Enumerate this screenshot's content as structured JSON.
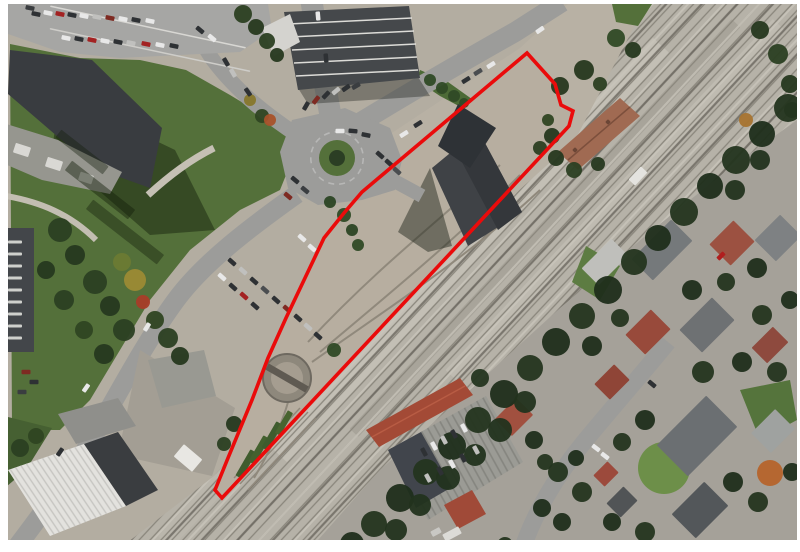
{
  "canvas": {
    "width": 800,
    "height": 552,
    "page_background": "#ffffff",
    "photo": {
      "x": 8,
      "y": 4,
      "width": 789,
      "height": 536
    }
  },
  "palette": {
    "page": "#ffffff",
    "base": "#b3ada1",
    "corridor": "#b6b2a8",
    "track_line": "#8a867c",
    "track_dark": "#6f6b63",
    "ballast_light": "#c6c2b8",
    "dirt": "#b8b1a4",
    "interior_dirt": "#b7aea0",
    "road": "#9c9c9a",
    "se_base": "#a5a199",
    "grass": "#54703a",
    "grass_dark": "#31451f",
    "grass_bright": "#6d8f49",
    "tree_dark": "#24351f",
    "roof_dark": "#3f4246",
    "roof_gray": "#85888a",
    "roof_red": "#9c5141",
    "roof_brick": "#a34a36",
    "white_roof": "#e3e2de",
    "boundary_red": "#ea0b0b"
  },
  "boundary": {
    "label": "site-boundary-annotation",
    "color": "#ea0b0b",
    "stroke_width": 3.6,
    "points": [
      [
        527,
        53
      ],
      [
        555,
        84
      ],
      [
        561,
        105
      ],
      [
        573,
        111
      ],
      [
        569,
        126
      ],
      [
        222,
        498
      ],
      [
        215,
        490
      ],
      [
        228,
        458
      ],
      [
        252,
        400
      ],
      [
        268,
        358
      ],
      [
        286,
        318
      ],
      [
        305,
        278
      ],
      [
        324,
        238
      ],
      [
        344,
        213
      ],
      [
        362,
        192
      ]
    ]
  },
  "scene": {
    "turntable": {
      "cx": 287,
      "cy": 378,
      "r_outer": 24,
      "r_inner": 16,
      "bridge_rot": 30
    },
    "roundabout": {
      "cx": 337,
      "cy": 158,
      "r_ring": 41,
      "r_green": 18,
      "r_bush": 8
    },
    "ballast_bands": [
      [
        470,
        250,
        560,
        22,
        -47,
        "#c3bfb5"
      ],
      [
        545,
        228,
        560,
        12,
        -47,
        "#a8a49a"
      ],
      [
        615,
        200,
        480,
        16,
        -47,
        "#bfbbb1"
      ],
      [
        350,
        340,
        380,
        14,
        -47,
        "#a29e94"
      ],
      [
        260,
        440,
        280,
        18,
        -47,
        "#bab6ac"
      ]
    ],
    "deco_rects": [
      [
        246,
        464,
        30,
        7,
        -60,
        "#3f5c2e"
      ],
      [
        259,
        450,
        30,
        7,
        -60,
        "#44612f"
      ],
      [
        272,
        436,
        30,
        7,
        -60,
        "#3f5c2e"
      ],
      [
        284,
        423,
        26,
        6,
        -60,
        "#486430"
      ],
      [
        15,
        242,
        14,
        3,
        0,
        "#cfd0cc"
      ],
      [
        15,
        254,
        14,
        3,
        0,
        "#cfd0cc"
      ],
      [
        15,
        266,
        14,
        3,
        0,
        "#cfd0cc"
      ],
      [
        15,
        278,
        14,
        3,
        0,
        "#cfd0cc"
      ],
      [
        15,
        290,
        14,
        3,
        0,
        "#cfd0cc"
      ],
      [
        15,
        302,
        14,
        3,
        0,
        "#cfd0cc"
      ],
      [
        15,
        314,
        14,
        3,
        0,
        "#cfd0cc"
      ],
      [
        15,
        326,
        14,
        3,
        0,
        "#cfd0cc"
      ],
      [
        15,
        338,
        14,
        3,
        0,
        "#cfd0cc"
      ],
      [
        22,
        150,
        16,
        10,
        18,
        "#d9d8d4"
      ],
      [
        54,
        164,
        16,
        10,
        18,
        "#d9d8d4"
      ],
      [
        86,
        178,
        14,
        9,
        18,
        "#cfceca"
      ],
      [
        188,
        458,
        24,
        16,
        40,
        "#e8e7e3"
      ],
      [
        638,
        176,
        18,
        9,
        -47,
        "#e4e3df"
      ],
      [
        575,
        150,
        4,
        4,
        -45,
        "#6b4636"
      ],
      [
        608,
        122,
        4,
        4,
        -45,
        "#6b4636"
      ],
      [
        452,
        534,
        18,
        8,
        -28,
        "#dcdbd7"
      ],
      [
        436,
        532,
        10,
        6,
        -28,
        "#c9c8c4"
      ],
      [
        148,
        27,
        200,
        1.5,
        12,
        "#d8d7d3"
      ],
      [
        150,
        50,
        205,
        1.5,
        12,
        "#cecdc9"
      ],
      [
        100,
        190,
        80,
        12,
        38,
        "rgba(20,30,12,0.45)"
      ],
      [
        125,
        232,
        90,
        12,
        38,
        "rgba(20,30,12,0.40)"
      ],
      [
        82,
        152,
        60,
        10,
        38,
        "rgba(20,30,12,0.40)"
      ]
    ],
    "houses": [
      [
        605,
        262,
        42,
        24,
        -45,
        "#bfbfbb"
      ],
      [
        662,
        250,
        56,
        30,
        -45,
        "#75797b"
      ],
      [
        732,
        243,
        34,
        30,
        -45,
        "#9c5141"
      ],
      [
        778,
        238,
        36,
        30,
        -45,
        "#7e8183"
      ],
      [
        648,
        332,
        36,
        28,
        -45,
        "#984a3b"
      ],
      [
        707,
        325,
        46,
        32,
        -45,
        "#6e7173"
      ],
      [
        770,
        345,
        30,
        22,
        -45,
        "#8e4a3e"
      ],
      [
        612,
        382,
        28,
        22,
        -45,
        "#8f4537"
      ],
      [
        697,
        436,
        70,
        44,
        -45,
        "#6b6f72"
      ],
      [
        773,
        431,
        34,
        28,
        -45,
        "#9fa2a0"
      ],
      [
        700,
        510,
        46,
        34,
        -45,
        "#53575a"
      ],
      [
        622,
        502,
        24,
        20,
        -45,
        "#515456"
      ],
      [
        606,
        474,
        20,
        16,
        -45,
        "#9c4a3c"
      ],
      [
        514,
        417,
        30,
        24,
        -45,
        "#a1503f"
      ]
    ],
    "trees": [
      [
        243,
        14,
        9,
        "#2b3f22"
      ],
      [
        256,
        27,
        8,
        "#26381f"
      ],
      [
        267,
        41,
        8,
        "#2b3f22"
      ],
      [
        277,
        55,
        7,
        "#26381f"
      ],
      [
        60,
        230,
        12,
        "#2b3f22"
      ],
      [
        75,
        255,
        10,
        "#26381f"
      ],
      [
        95,
        282,
        12,
        "#2b3f22"
      ],
      [
        110,
        306,
        10,
        "#26381f"
      ],
      [
        124,
        330,
        11,
        "#2b3f22"
      ],
      [
        104,
        354,
        10,
        "#26381f"
      ],
      [
        84,
        330,
        9,
        "#2f4522"
      ],
      [
        64,
        300,
        10,
        "#2b3f22"
      ],
      [
        46,
        270,
        9,
        "#26381f"
      ],
      [
        135,
        280,
        11,
        "#9c8a34"
      ],
      [
        143,
        302,
        7,
        "#a83c28"
      ],
      [
        122,
        262,
        9,
        "#6b7a33"
      ],
      [
        155,
        320,
        9,
        "#2f4522"
      ],
      [
        168,
        338,
        10,
        "#2b3f22"
      ],
      [
        180,
        356,
        9,
        "#26381f"
      ],
      [
        20,
        448,
        9,
        "#2b3f22"
      ],
      [
        36,
        436,
        8,
        "#2f4522"
      ],
      [
        430,
        80,
        6,
        "#2f4a26"
      ],
      [
        442,
        88,
        6,
        "#2f4a26"
      ],
      [
        454,
        96,
        6,
        "#2f4a26"
      ],
      [
        464,
        103,
        5,
        "#2f4a26"
      ],
      [
        262,
        116,
        7,
        "#2f4522"
      ],
      [
        250,
        100,
        6,
        "#87772c"
      ],
      [
        270,
        120,
        6,
        "#a8522a"
      ],
      [
        560,
        86,
        9,
        "#26381f"
      ],
      [
        584,
        70,
        10,
        "#26381f"
      ],
      [
        600,
        84,
        7,
        "#2b3f22"
      ],
      [
        548,
        120,
        6,
        "#2f4522"
      ],
      [
        556,
        158,
        8,
        "#26381f"
      ],
      [
        574,
        170,
        8,
        "#2b3f22"
      ],
      [
        598,
        164,
        7,
        "#26381f"
      ],
      [
        552,
        136,
        8,
        "#26381f"
      ],
      [
        540,
        148,
        7,
        "#2b3f22"
      ],
      [
        616,
        38,
        9,
        "#2f4a26"
      ],
      [
        633,
        50,
        8,
        "#26381f"
      ],
      [
        760,
        30,
        9,
        "#26381f"
      ],
      [
        778,
        54,
        10,
        "#2b3f22"
      ],
      [
        790,
        84,
        9,
        "#26381f"
      ],
      [
        792,
        110,
        8,
        "#2b3f22"
      ],
      [
        788,
        108,
        14,
        "#24351f"
      ],
      [
        762,
        134,
        13,
        "#1f2e1b"
      ],
      [
        736,
        160,
        14,
        "#24351f"
      ],
      [
        710,
        186,
        13,
        "#1f2e1b"
      ],
      [
        684,
        212,
        14,
        "#24351f"
      ],
      [
        658,
        238,
        13,
        "#1f2e1b"
      ],
      [
        634,
        262,
        13,
        "#24351f"
      ],
      [
        608,
        290,
        14,
        "#1f2e1b"
      ],
      [
        582,
        316,
        13,
        "#24351f"
      ],
      [
        556,
        342,
        14,
        "#1f2e1b"
      ],
      [
        530,
        368,
        13,
        "#24351f"
      ],
      [
        504,
        394,
        14,
        "#1f2e1b"
      ],
      [
        478,
        420,
        13,
        "#24351f"
      ],
      [
        452,
        446,
        14,
        "#1f2e1b"
      ],
      [
        426,
        472,
        13,
        "#24351f"
      ],
      [
        400,
        498,
        14,
        "#1f2e1b"
      ],
      [
        374,
        524,
        13,
        "#24351f"
      ],
      [
        352,
        544,
        12,
        "#1f2e1b"
      ],
      [
        500,
        430,
        12,
        "#22331d"
      ],
      [
        525,
        402,
        11,
        "#22331d"
      ],
      [
        475,
        455,
        11,
        "#22331d"
      ],
      [
        448,
        478,
        12,
        "#22331d"
      ],
      [
        420,
        505,
        11,
        "#22331d"
      ],
      [
        396,
        530,
        11,
        "#22331d"
      ],
      [
        760,
        160,
        10,
        "#22331d"
      ],
      [
        735,
        190,
        10,
        "#22331d"
      ],
      [
        746,
        120,
        7,
        "#a87430"
      ],
      [
        692,
        290,
        10,
        "#1f2e1b"
      ],
      [
        726,
        282,
        9,
        "#24351f"
      ],
      [
        757,
        268,
        10,
        "#1f2e1b"
      ],
      [
        620,
        318,
        9,
        "#24351f"
      ],
      [
        592,
        346,
        10,
        "#1f2e1b"
      ],
      [
        762,
        315,
        10,
        "#24351f"
      ],
      [
        790,
        300,
        9,
        "#1f2e1b"
      ],
      [
        703,
        372,
        11,
        "#24351f"
      ],
      [
        742,
        362,
        10,
        "#1f2e1b"
      ],
      [
        777,
        372,
        10,
        "#24351f"
      ],
      [
        645,
        420,
        10,
        "#1f2e1b"
      ],
      [
        622,
        442,
        9,
        "#24351f"
      ],
      [
        733,
        482,
        10,
        "#1f2e1b"
      ],
      [
        758,
        502,
        10,
        "#24351f"
      ],
      [
        792,
        472,
        9,
        "#1f2e1b"
      ],
      [
        645,
        532,
        10,
        "#24351f"
      ],
      [
        612,
        522,
        9,
        "#1f2e1b"
      ],
      [
        582,
        492,
        10,
        "#24351f"
      ],
      [
        562,
        522,
        9,
        "#1f2e1b"
      ],
      [
        545,
        462,
        8,
        "#24351f"
      ],
      [
        576,
        458,
        8,
        "#1f2e1b"
      ],
      [
        770,
        473,
        13,
        "#b5642b"
      ],
      [
        480,
        378,
        9,
        "#24351f"
      ],
      [
        534,
        440,
        9,
        "#1f2e1b"
      ],
      [
        558,
        472,
        10,
        "#24351f"
      ],
      [
        542,
        508,
        9,
        "#1f2e1b"
      ],
      [
        505,
        545,
        8,
        "#24351f"
      ],
      [
        334,
        350,
        7,
        "#2f4a26"
      ],
      [
        344,
        215,
        7,
        "#2f4a26"
      ],
      [
        352,
        230,
        6,
        "#2b4424"
      ],
      [
        358,
        245,
        6,
        "#2f4a26"
      ],
      [
        330,
        202,
        6,
        "#2b4424"
      ],
      [
        234,
        424,
        8,
        "#26381f"
      ],
      [
        224,
        444,
        7,
        "#2b3f22"
      ]
    ],
    "cars": [
      [
        36,
        14,
        12,
        "#2e3134"
      ],
      [
        48,
        13,
        12,
        "#e8e8e8"
      ],
      [
        60,
        14,
        12,
        "#a32222"
      ],
      [
        72,
        15,
        12,
        "#2e3134"
      ],
      [
        84,
        16,
        12,
        "#e8e8e8"
      ],
      [
        97,
        17,
        12,
        "#c0c0be"
      ],
      [
        110,
        18,
        12,
        "#7e2a22"
      ],
      [
        123,
        19,
        12,
        "#e8e8e8"
      ],
      [
        136,
        20,
        12,
        "#2e3134"
      ],
      [
        150,
        21,
        12,
        "#e8e8e8"
      ],
      [
        66,
        38,
        12,
        "#e8e8e8"
      ],
      [
        79,
        39,
        12,
        "#2e3134"
      ],
      [
        92,
        40,
        12,
        "#a32222"
      ],
      [
        105,
        41,
        12,
        "#e8e8e8"
      ],
      [
        118,
        42,
        12,
        "#2e3134"
      ],
      [
        131,
        43,
        12,
        "#c0c0be"
      ],
      [
        146,
        44,
        12,
        "#a32222"
      ],
      [
        160,
        45,
        12,
        "#e8e8e8"
      ],
      [
        174,
        46,
        12,
        "#2e3134"
      ],
      [
        30,
        8,
        12,
        "#3a3d40"
      ],
      [
        200,
        30,
        40,
        "#2e3134"
      ],
      [
        212,
        38,
        40,
        "#e8e8e8"
      ],
      [
        306,
        106,
        -60,
        "#2e3134"
      ],
      [
        316,
        100,
        -52,
        "#7e2a22"
      ],
      [
        326,
        95,
        -46,
        "#2e3134"
      ],
      [
        336,
        91,
        -40,
        "#c0c0be"
      ],
      [
        346,
        88,
        -35,
        "#2e3134"
      ],
      [
        356,
        86,
        -30,
        "#3a3d40"
      ],
      [
        318,
        16,
        85,
        "#e8e8e8"
      ],
      [
        326,
        58,
        85,
        "#2e3134"
      ],
      [
        404,
        134,
        -32,
        "#e8e8e8"
      ],
      [
        418,
        124,
        -32,
        "#2e3134"
      ],
      [
        466,
        80,
        -32,
        "#2e3134"
      ],
      [
        478,
        72,
        -32,
        "#4a4d50"
      ],
      [
        491,
        65,
        -32,
        "#e8e8e8"
      ],
      [
        540,
        30,
        -35,
        "#e8e8e8"
      ],
      [
        340,
        131,
        0,
        "#e8e8e8"
      ],
      [
        353,
        131,
        5,
        "#2e3134"
      ],
      [
        366,
        135,
        12,
        "#2e3134"
      ],
      [
        295,
        180,
        40,
        "#2e3134"
      ],
      [
        305,
        190,
        40,
        "#3a3d40"
      ],
      [
        288,
        196,
        40,
        "#7e2a22"
      ],
      [
        380,
        155,
        42,
        "#2e3134"
      ],
      [
        389,
        163,
        42,
        "#2e3134"
      ],
      [
        397,
        171,
        42,
        "#4a4d50"
      ],
      [
        226,
        62,
        60,
        "#2e3134"
      ],
      [
        233,
        73,
        60,
        "#c0c0be"
      ],
      [
        248,
        92,
        55,
        "#2e3134"
      ],
      [
        232,
        262,
        42,
        "#2e3134"
      ],
      [
        243,
        271,
        42,
        "#c0c0be"
      ],
      [
        254,
        281,
        42,
        "#2e3134"
      ],
      [
        265,
        290,
        42,
        "#4a4d50"
      ],
      [
        276,
        300,
        42,
        "#2e3134"
      ],
      [
        287,
        309,
        42,
        "#7e2a22"
      ],
      [
        298,
        318,
        42,
        "#2e3134"
      ],
      [
        308,
        327,
        42,
        "#c0c0be"
      ],
      [
        318,
        336,
        42,
        "#2e3134"
      ],
      [
        222,
        277,
        42,
        "#e8e8e8"
      ],
      [
        233,
        287,
        42,
        "#2e3134"
      ],
      [
        244,
        296,
        42,
        "#a32222"
      ],
      [
        255,
        306,
        42,
        "#2e3134"
      ],
      [
        302,
        238,
        42,
        "#e8e8e8"
      ],
      [
        312,
        248,
        42,
        "#e8e8e8"
      ],
      [
        147,
        327,
        -58,
        "#e8e8e8"
      ],
      [
        86,
        388,
        -55,
        "#e8e8e8"
      ],
      [
        60,
        452,
        -55,
        "#2e3134"
      ],
      [
        26,
        372,
        0,
        "#7e2a22"
      ],
      [
        34,
        382,
        0,
        "#2e3134"
      ],
      [
        22,
        392,
        0,
        "#3a3d40"
      ],
      [
        652,
        384,
        40,
        "#2e3134"
      ],
      [
        596,
        448,
        38,
        "#e8e8e8"
      ],
      [
        605,
        456,
        38,
        "#e8e8e8"
      ],
      [
        721,
        256,
        -45,
        "#b01e1e"
      ],
      [
        424,
        452,
        62,
        "#2e3134"
      ],
      [
        434,
        446,
        62,
        "#e8e8e8"
      ],
      [
        444,
        440,
        62,
        "#c0c0be"
      ],
      [
        454,
        434,
        62,
        "#2e3134"
      ],
      [
        464,
        428,
        62,
        "#e8e8e8"
      ],
      [
        428,
        478,
        62,
        "#c0c0be"
      ],
      [
        440,
        471,
        62,
        "#2e3134"
      ],
      [
        452,
        464,
        62,
        "#e8e8e8"
      ],
      [
        463,
        458,
        62,
        "#2e3134"
      ],
      [
        476,
        450,
        62,
        "#c0c0be"
      ]
    ]
  }
}
